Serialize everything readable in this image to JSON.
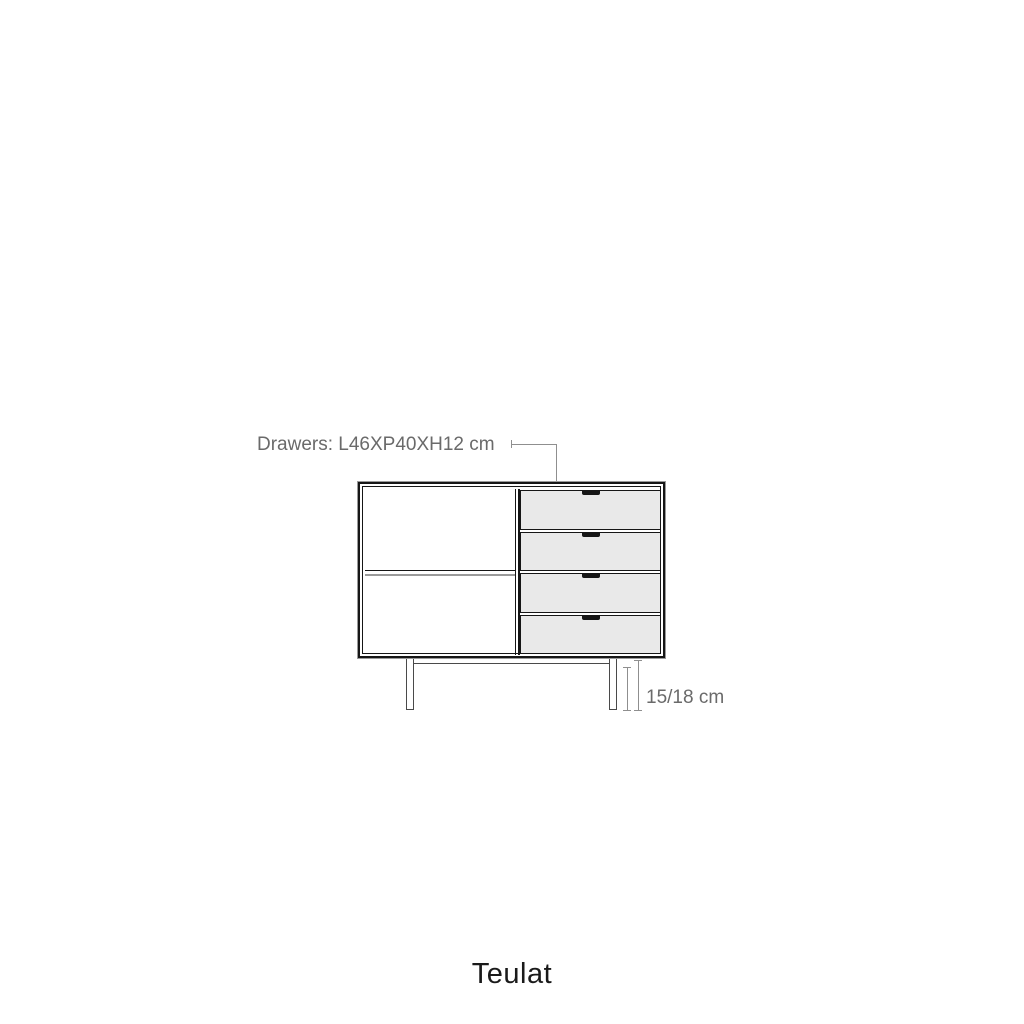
{
  "page": {
    "background": "#ffffff"
  },
  "colors": {
    "line_dark": "#161616",
    "line_gray": "#8f8f8f",
    "hairline_gray": "#9a9a9a",
    "text_gray": "#6a6a6a",
    "drawer_fill": "#e9e9e9",
    "leg_line": "#4a4a4a",
    "brand_color": "#1a1a1a",
    "page_bg": "#ffffff"
  },
  "diagram": {
    "drawers_label": "Drawers: L46XP40XH12 cm",
    "width_dimension": "51 cm",
    "height_dimension": "29 cm",
    "legs_dimension": "15/18 cm",
    "drawer_count": 4
  },
  "brand": {
    "logo_text": "Teulat"
  }
}
